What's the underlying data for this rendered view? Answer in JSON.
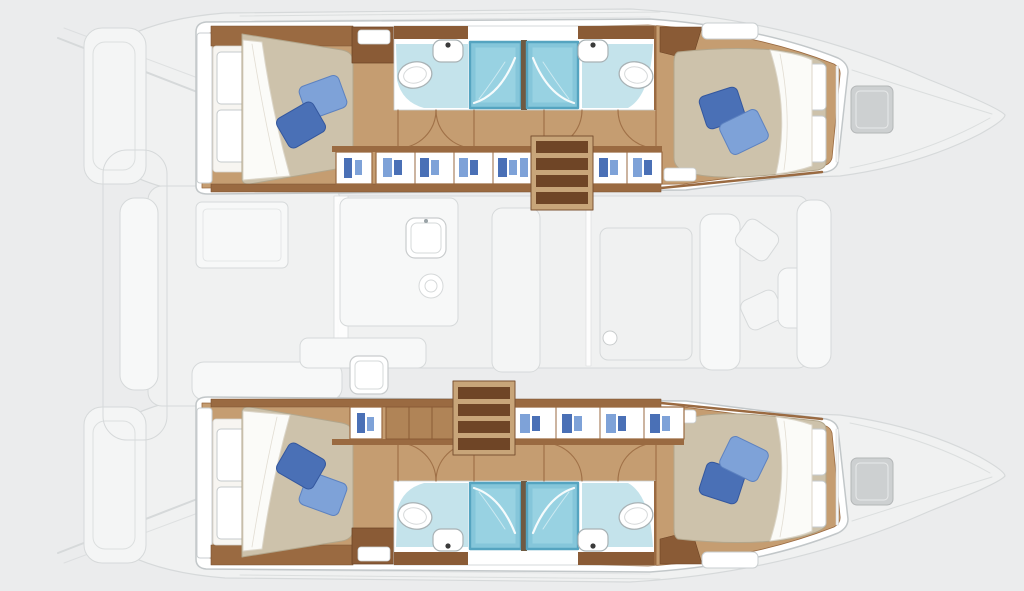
{
  "title": "Catamaran interior layout floor plan, top view, bow pointing right",
  "colors": {
    "bg": "#ebeced",
    "ghost_fill": "#f4f5f5",
    "ghost_fill2": "#f0f1f1",
    "ghost_fill3": "#f7f8f8",
    "ghost_line": "#d6d9da",
    "ghost_line2": "#c9cccd",
    "rim_line": "#c2c7c9",
    "white": "#ffffff",
    "wood_floor": "#c59d71",
    "wood_mid": "#b08457",
    "wood_frame": "#9a6a41",
    "wood_dark": "#7b5233",
    "cabinet_dark": "#8a5b36",
    "stair_tread": "#6f4526",
    "stair_side": "#c8a579",
    "headboard": "#f7f5f1",
    "mattress": "#cdc2ab",
    "mattress_line": "#b2a68c",
    "sheet": "#fbfbf8",
    "sheet_line": "#dcd6c9",
    "pillow_dark": "#4a70b6",
    "pillow_light": "#7ea2d8",
    "teal_floor": "#c4e3eb",
    "shower": "#85c6da",
    "shower_light": "#a8dcea",
    "shower_frame": "#55a4c0",
    "divider": "#6f5a42",
    "fixture_line": "#a9b2b5",
    "hatch": "#cdd0d1",
    "dot": "#3a3a3a"
  },
  "rooms": {
    "port_hull": [
      "aft-cabin",
      "aft-head",
      "shower",
      "companionway-stairs",
      "wardrobes",
      "fwd-head",
      "fwd-cabin"
    ],
    "starboard_hull": [
      "aft-cabin",
      "aft-head",
      "shower",
      "companionway-stairs",
      "wardrobes",
      "fwd-head",
      "fwd-cabin"
    ],
    "deck_ghosts": [
      "stern-platforms",
      "aft-cockpit-bench",
      "cockpit-table",
      "saloon",
      "galley-counter",
      "galley-sink",
      "stove",
      "dining-table",
      "sofa",
      "armchairs",
      "side-table",
      "mast-step",
      "foredeck-hatches"
    ]
  }
}
